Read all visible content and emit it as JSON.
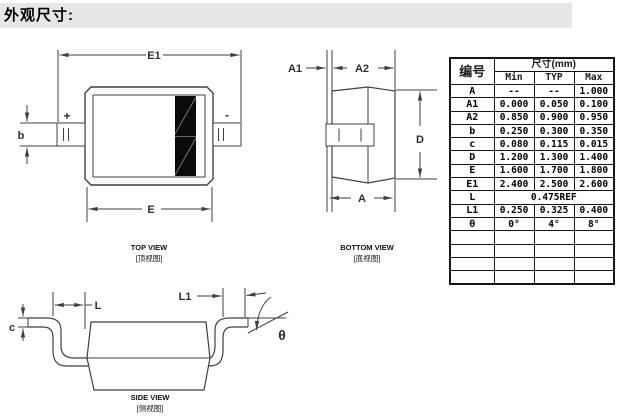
{
  "title": "外观尺寸:",
  "drawing": {
    "top_view": {
      "caption_en": "TOP VIEW",
      "caption_cn": "[顶视图]",
      "labels": {
        "E1": "E1",
        "E": "E",
        "b": "b",
        "plus": "+",
        "minus": "-"
      }
    },
    "bottom_view": {
      "caption_en": "BOTTOM VIEW",
      "caption_cn": "[底视图]",
      "labels": {
        "A1": "A1",
        "A2": "A2",
        "A": "A",
        "D": "D"
      }
    },
    "side_view": {
      "caption_en": "SIDE VIEW",
      "caption_cn": "[侧视图]",
      "labels": {
        "c": "c",
        "L": "L",
        "L1": "L1",
        "theta": "θ"
      }
    }
  },
  "table": {
    "corner_header": "编号",
    "size_header": "尺寸(mm)",
    "col_headers": [
      "Min",
      "TYP",
      "Max"
    ],
    "rows": [
      {
        "id": "A",
        "min": "--",
        "typ": "--",
        "max": "1.000"
      },
      {
        "id": "A1",
        "min": "0.000",
        "typ": "0.050",
        "max": "0.100"
      },
      {
        "id": "A2",
        "min": "0.850",
        "typ": "0.900",
        "max": "0.950"
      },
      {
        "id": "b",
        "min": "0.250",
        "typ": "0.300",
        "max": "0.350"
      },
      {
        "id": "c",
        "min": "0.080",
        "typ": "0.115",
        "max": "0.015"
      },
      {
        "id": "D",
        "min": "1.200",
        "typ": "1.300",
        "max": "1.400"
      },
      {
        "id": "E",
        "min": "1.600",
        "typ": "1.700",
        "max": "1.800"
      },
      {
        "id": "E1",
        "min": "2.400",
        "typ": "2.500",
        "max": "2.600"
      },
      {
        "id": "L",
        "span": "0.475REF"
      },
      {
        "id": "L1",
        "min": "0.250",
        "typ": "0.325",
        "max": "0.400"
      },
      {
        "id": "θ",
        "min": "0°",
        "typ": "4°",
        "max": "8°"
      },
      {
        "id": "",
        "min": "",
        "typ": "",
        "max": ""
      },
      {
        "id": "",
        "min": "",
        "typ": "",
        "max": ""
      },
      {
        "id": "",
        "min": "",
        "typ": "",
        "max": ""
      },
      {
        "id": "",
        "min": "",
        "typ": "",
        "max": ""
      }
    ]
  },
  "colors": {
    "line": "#3f3f3f",
    "title_band": "#e7e7e7",
    "table_border": "#161616",
    "cathode_band": "#0a0a0a"
  }
}
